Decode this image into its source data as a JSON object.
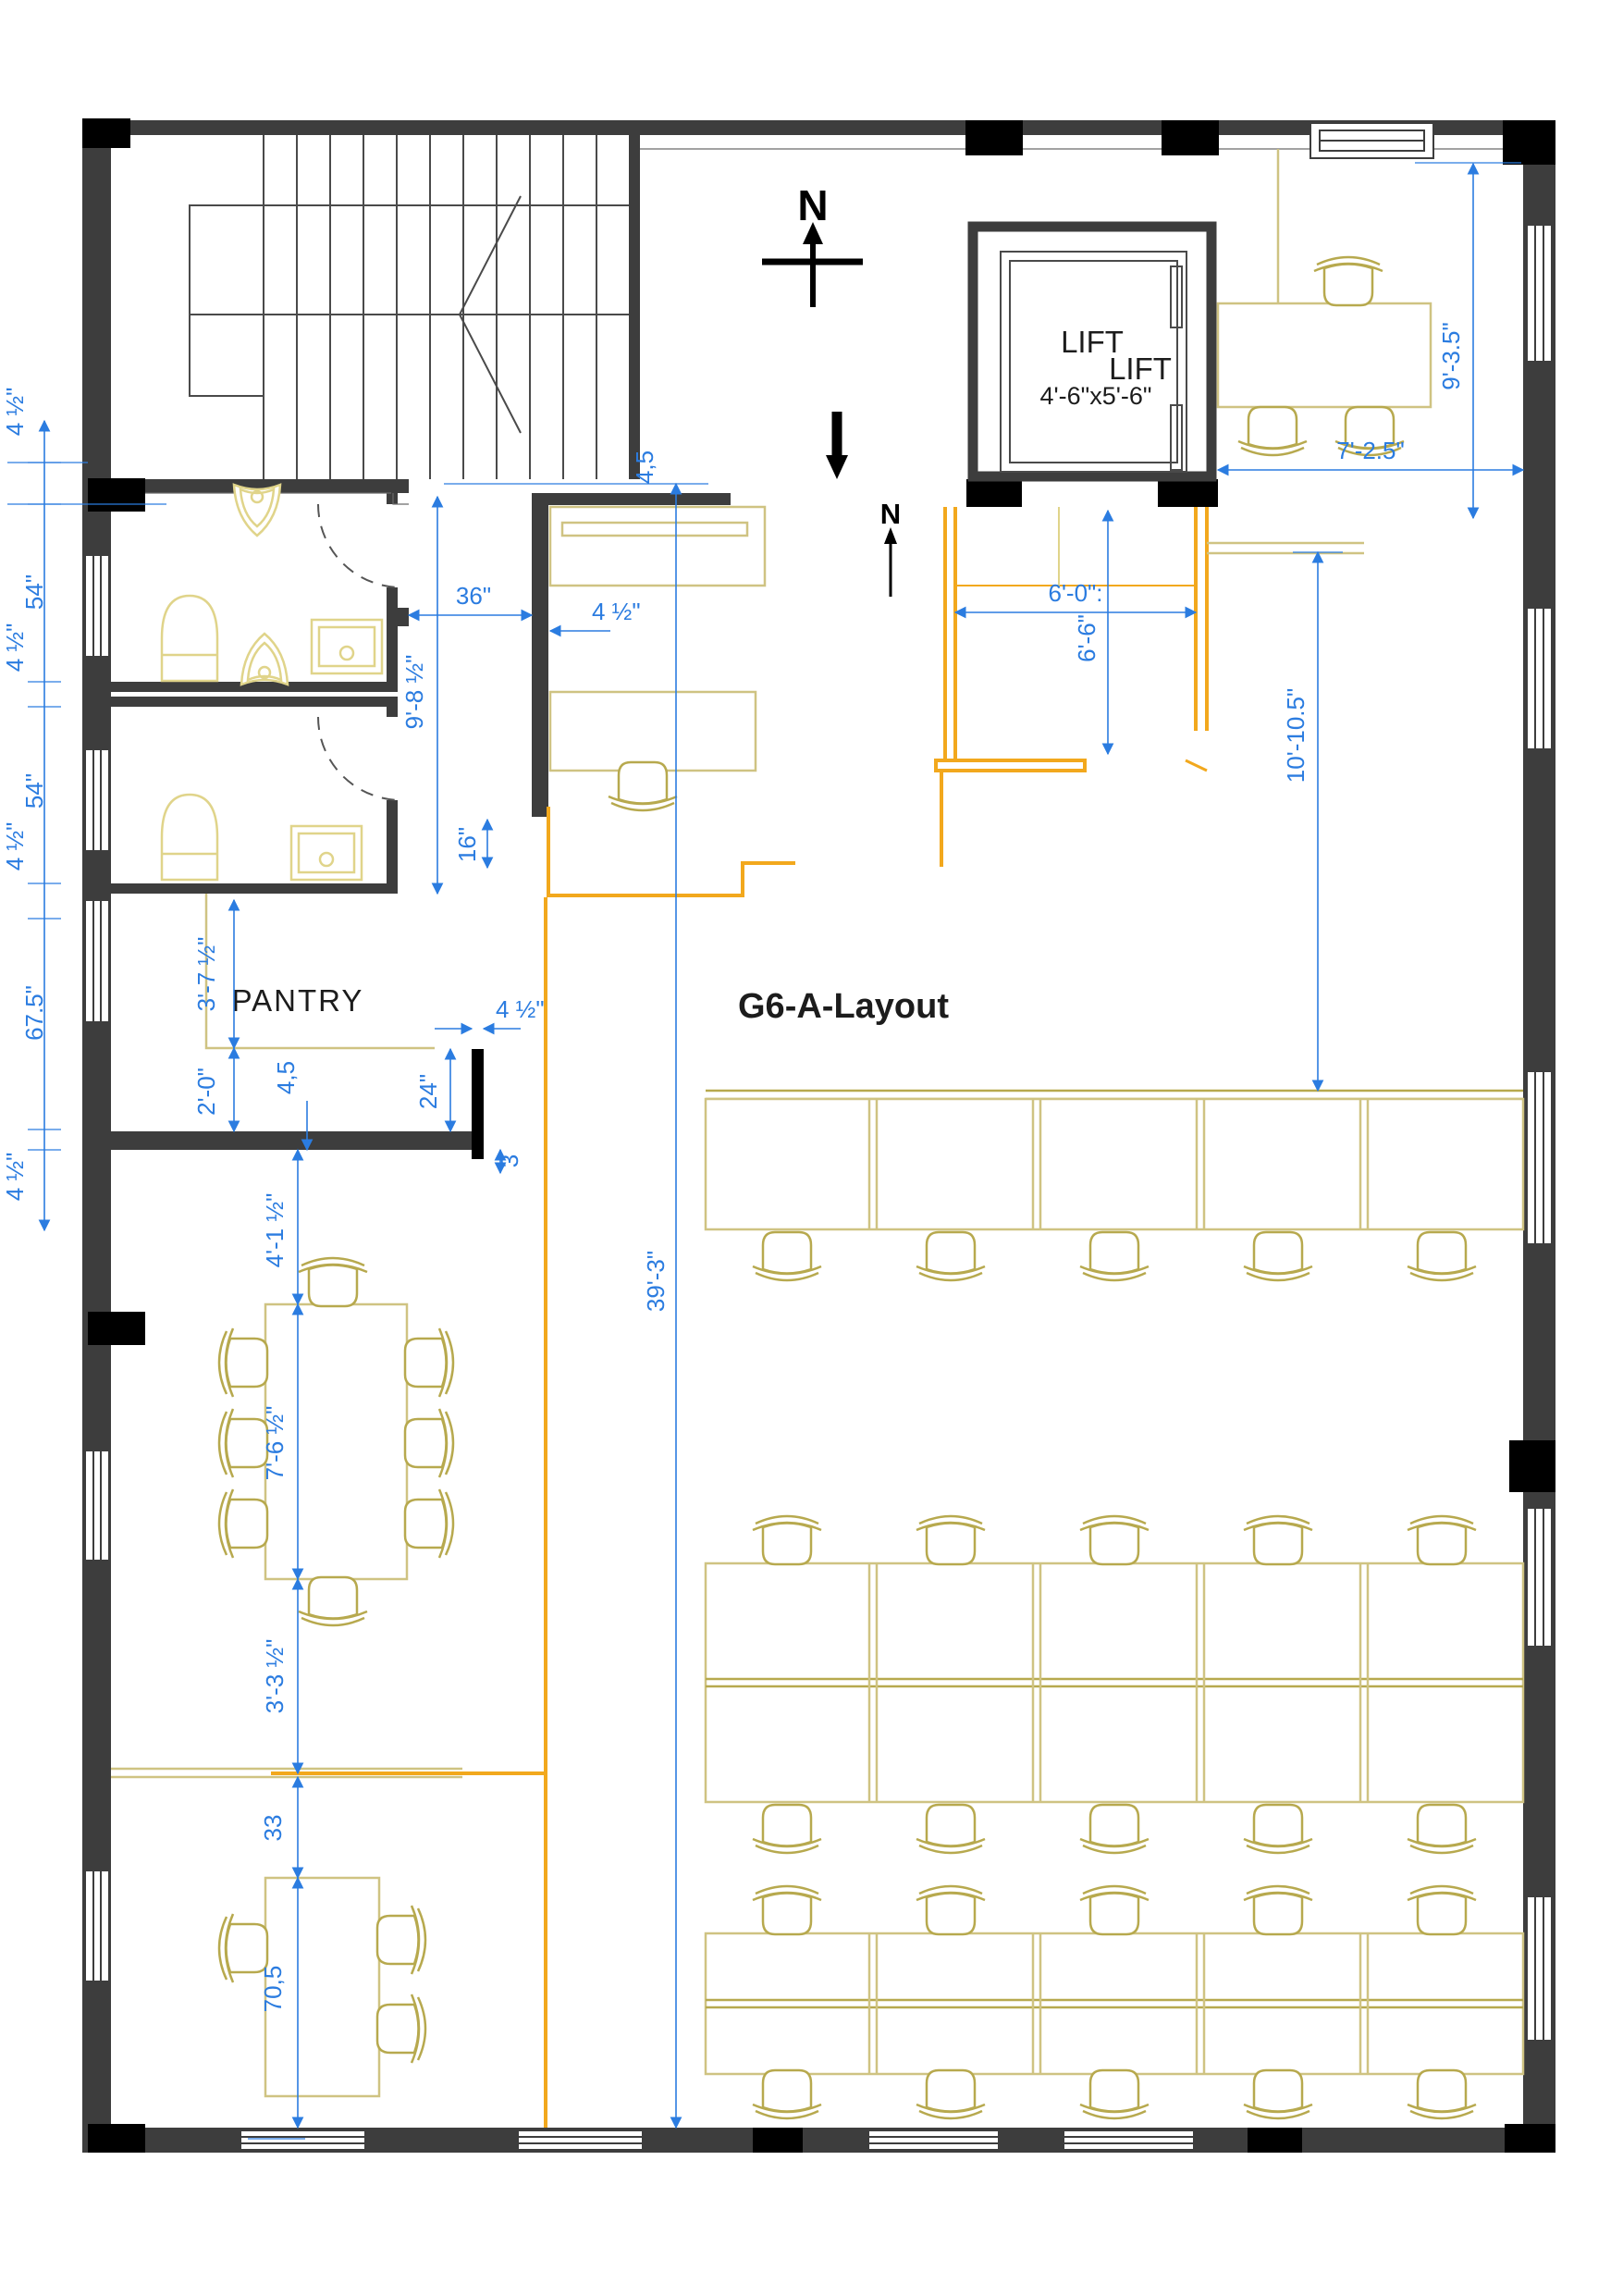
{
  "title": {
    "plan_label": "G6-A-Layout"
  },
  "rooms": {
    "pantry": "PANTRY",
    "lift_line1": "LIFT",
    "lift_line2": "LIFT",
    "lift_size": "4'-6\"x5'-6\""
  },
  "compass": {
    "north_main": "N",
    "north_secondary": "N"
  },
  "colors": {
    "dimension_blue": "#2b7ce0",
    "furniture_yellow": "#cfc382",
    "partition_orange": "#f2a81d",
    "wall_gray": "#3d3d3d"
  },
  "dims": {
    "lc1": "4 ½\"",
    "lc2": "54\"",
    "lc3": "4 ½\"",
    "lc4": "54\"",
    "lc5": "4 ½\"",
    "lc6": "67.5\"",
    "lc7": "4 ½\"",
    "off36": "36\"",
    "off45": "4 ½\"",
    "h985": "9'-8 ½\"",
    "d16": "16\"",
    "top45": "4,5",
    "v393": "39'-3\"",
    "p375": "3'-7 ½\"",
    "p20": "2'-0\"",
    "p45": "4,5",
    "stub45": "4 ½\"",
    "d24": "24\"",
    "d3": "3",
    "t415": "4'-1 ½\"",
    "t765": "7'-6 ½\"",
    "t335": "3'-3 ½\"",
    "t33": "33",
    "t705": "70,5",
    "r60": "6'-0\":",
    "r66": "6'-6\"",
    "r1010": "10'-10.5\"",
    "r935": "9'-3.5\"",
    "r725": "7'-2.5\""
  }
}
